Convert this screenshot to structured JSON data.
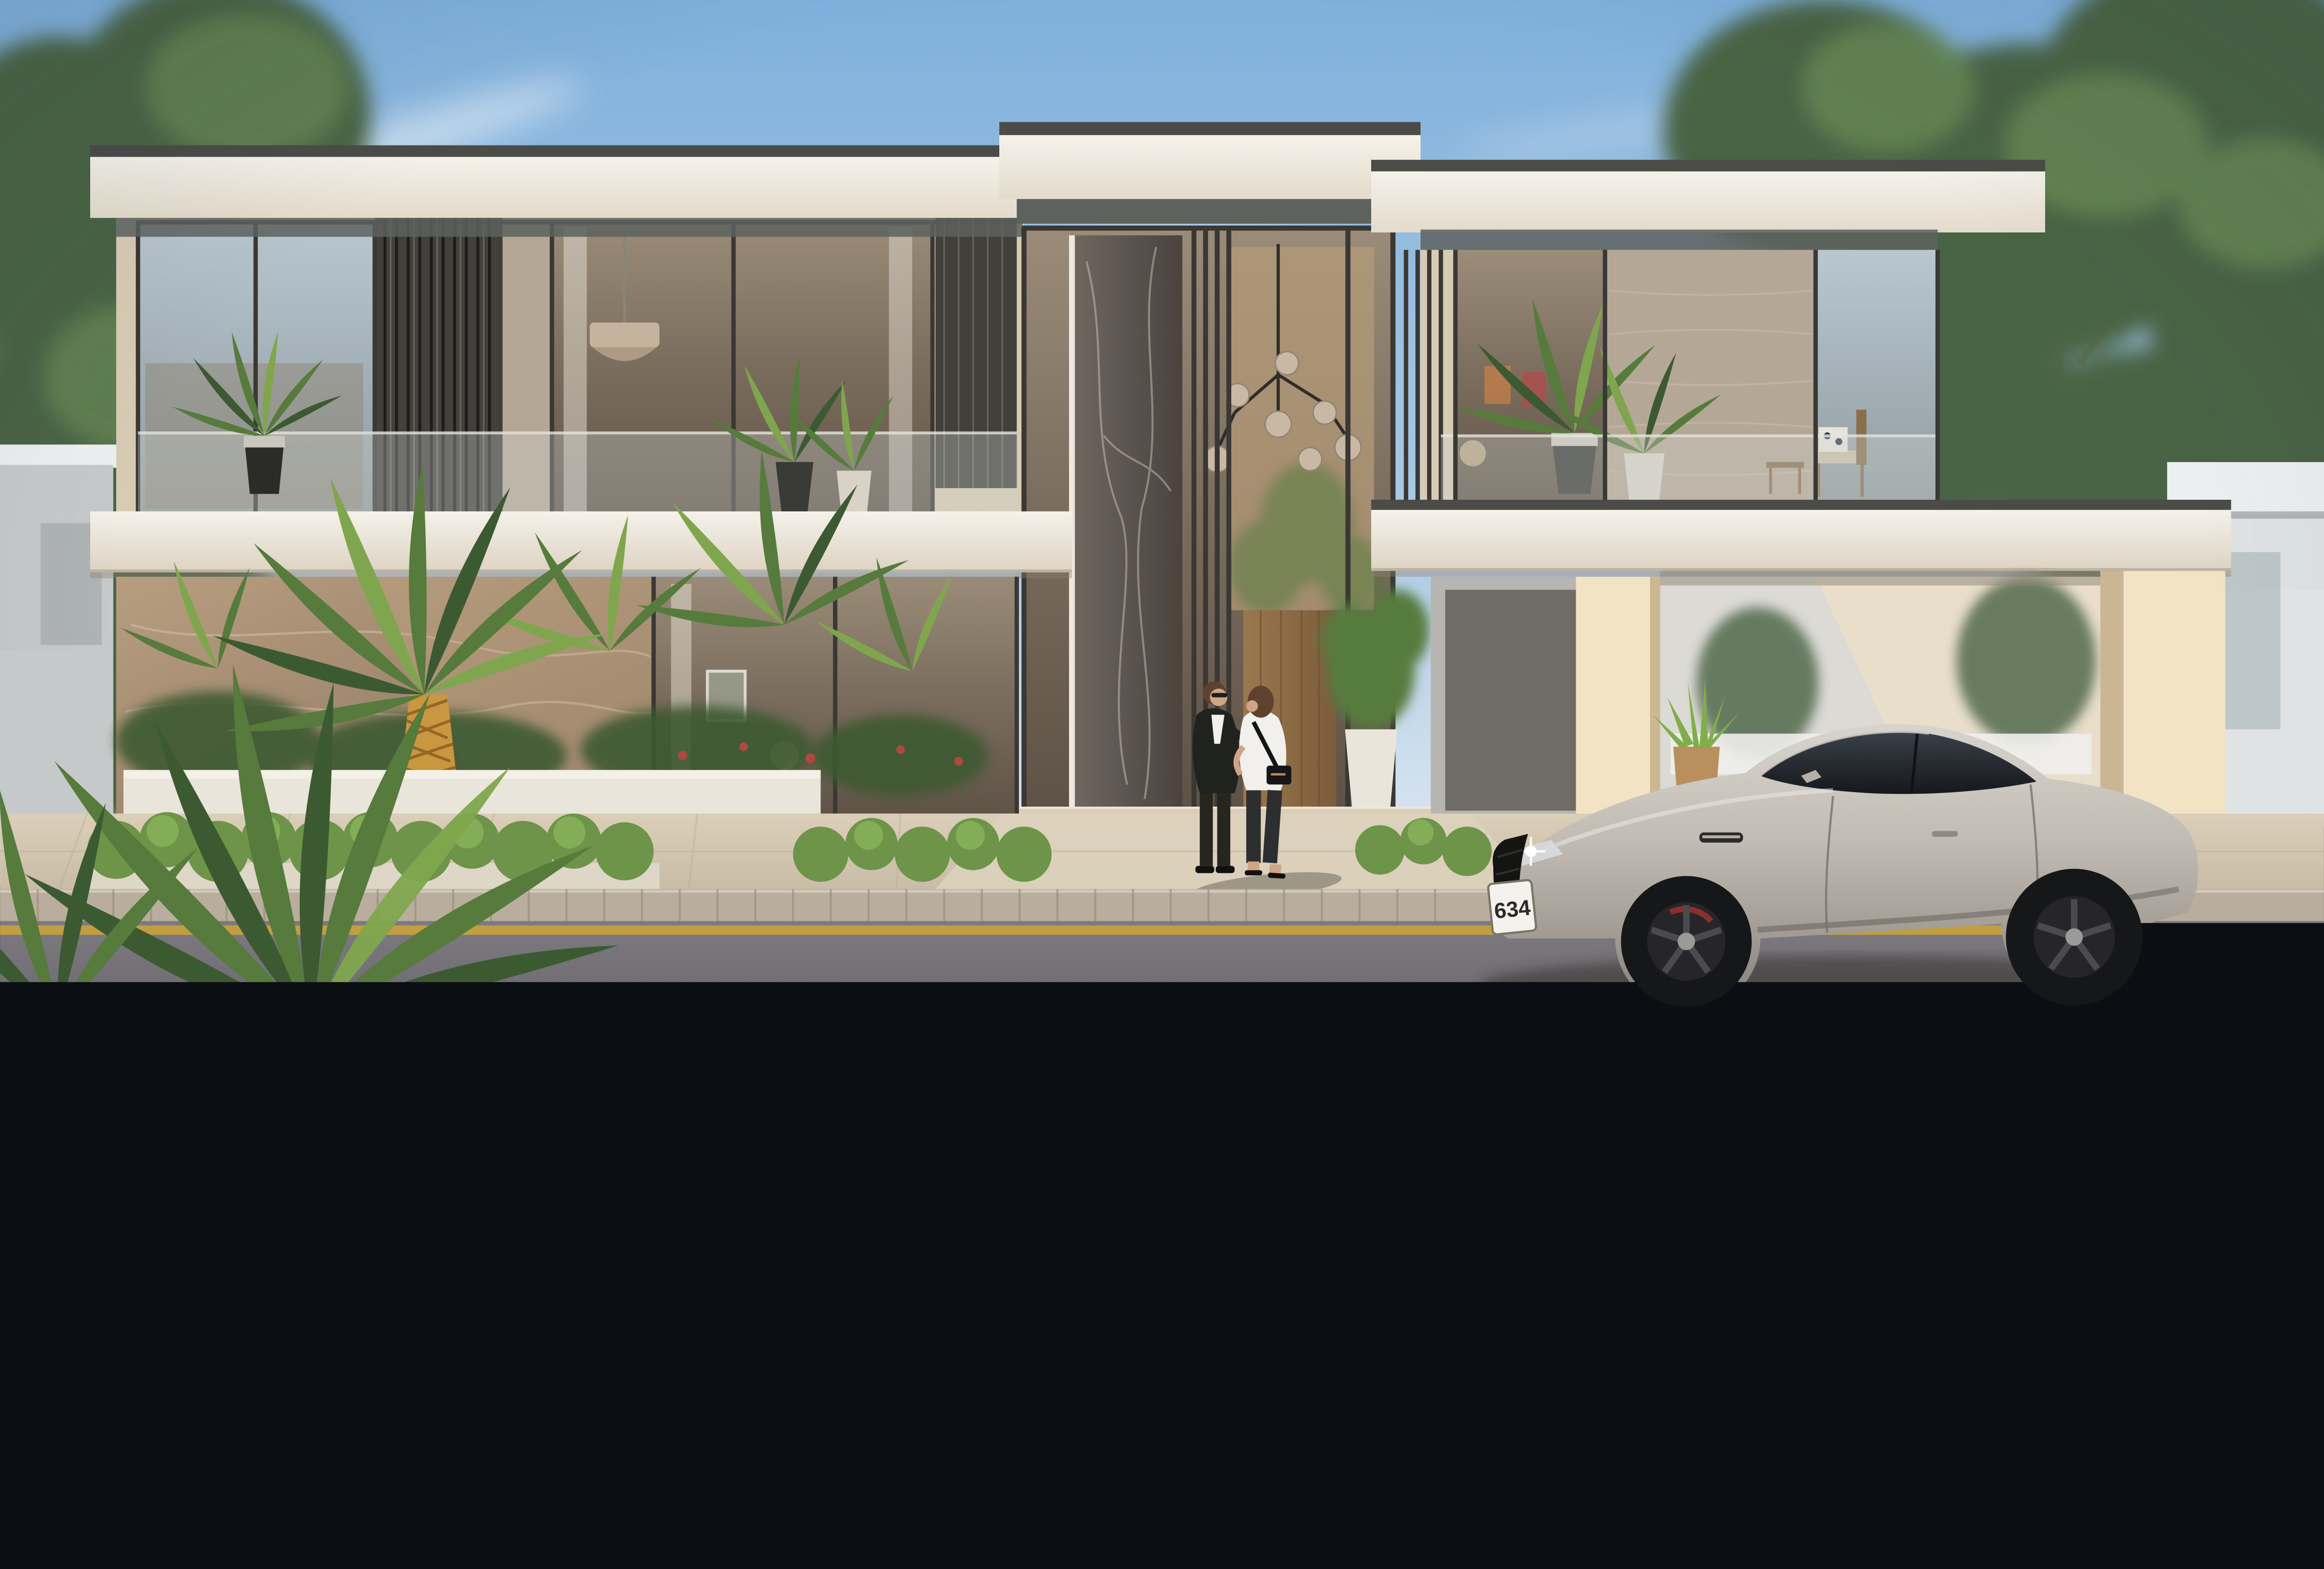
{
  "meta": {
    "kind": "photorealistic architectural exterior render",
    "subject": "two-storey modern luxury villa at dusk with sports coupe parked in front",
    "camera": "street-level frontal elevation view"
  },
  "palette": {
    "sky_top": "#7fb0dc",
    "sky_mid": "#abc9e3",
    "sky_horizon": "#e7eef3",
    "cloud": "#ffffff",
    "tree_green": "#4a6345",
    "tree_green_light": "#79a05e",
    "trunk": "#9c8a6b",
    "neighbor_white": "#eceff0",
    "neighbor_gray": "#c6c9c9",
    "roof_white": "#f5f2ea",
    "roof_cream": "#e3dbcb",
    "roof_trim_dark": "#4b4b48",
    "soffit_dark": "#5d625e",
    "facade_cream": "#ead9bb",
    "facade_cream_lit": "#f2e3c4",
    "travertine": "#b5a795",
    "marble_brown_light": "#b89e80",
    "marble_brown": "#8a7460",
    "marble_vein": "#cdbda6",
    "dark_marble_hi": "#6e665f",
    "dark_marble": "#4a433e",
    "frame_bronze": "#3a3835",
    "glass_cool_hi": "#b9c7cf",
    "glass_cool_lo": "#8f9894",
    "glass_warm_hi": "#9b8c79",
    "glass_warm_lo": "#5e5246",
    "wood_hi": "#9a784f",
    "wood_lo": "#7c5c3a",
    "planter_white": "#eae5da",
    "palm_dark": "#3c5a31",
    "palm_mid": "#567b3c",
    "palm_light": "#7fa64e",
    "hedge_bright": "#6d9448",
    "hedge_dark": "#3d5237",
    "grass": "#51703e",
    "flower_red": "#b0493a",
    "walk_hi": "#dbcfba",
    "walk_lo": "#c9bca6",
    "curb_stone": "#b9ae9d",
    "road_hi": "#7d7a80",
    "road_lo": "#56555b",
    "road_line_yellow": "#c9a23c",
    "pav_hi": "#b0b0ae",
    "pav_lo": "#8d8e91",
    "car_hi": "#d8d4cd",
    "car_mid": "#c2bcb4",
    "car_low": "#837e78",
    "car_glass_hi": "#3a4149",
    "car_glass_lo": "#16181c",
    "car_wheel": "#161719",
    "plate_white": "#f4f2ec",
    "plate_text": "#2b2b2b",
    "skin": "#cfa585",
    "hair_brown": "#5f4130",
    "suit_dark": "#20221e",
    "shirt_white": "#f2f0ec",
    "jeans_dark": "#2d2e30",
    "bag_black": "#15151a",
    "shadow": "#2e2a28"
  },
  "scene": {
    "villa": {
      "storeys": 2,
      "features": [
        "flat white roof slabs with dark trim",
        "double-height glazed entrance",
        "dark marble entry panel",
        "bronze vertical slat screens",
        "travertine and brown marble walls",
        "glass balustrade balconies with potted palms",
        "cantilevered carport"
      ]
    },
    "car": {
      "style": "luxury sports coupe",
      "color_name": "silver",
      "license_plate": "634",
      "wheels": "black multi-spoke"
    },
    "people": [
      {
        "description": "woman in dark suit with sunglasses holding phone"
      },
      {
        "description": "woman in white blouse with black shoulder bag"
      }
    ],
    "landscape": [
      "date palm",
      "tropical planters",
      "bright boxwood hedges",
      "dark foreground hedge",
      "street trees"
    ],
    "street": {
      "marking_color_name": "yellow",
      "road": "asphalt",
      "foreground_sidewalk": "granite pavers",
      "villa_sidewalk": "beige pavers"
    }
  }
}
